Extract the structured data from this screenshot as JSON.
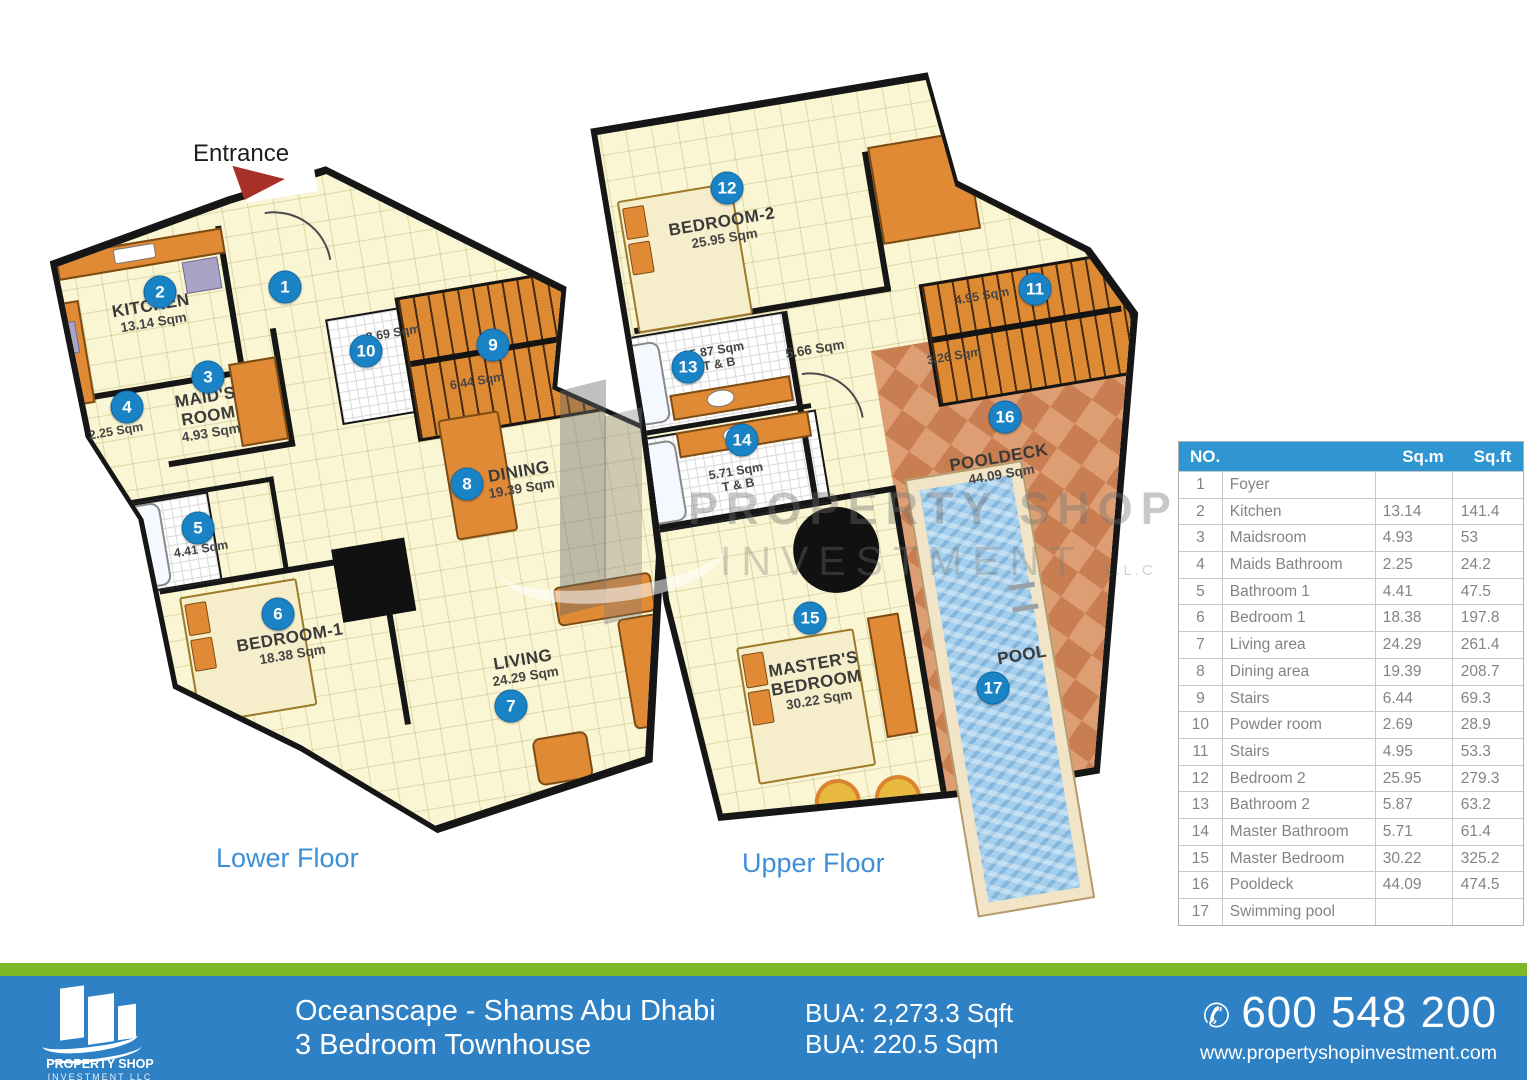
{
  "entrance_label": "Entrance",
  "floor_captions": {
    "lower": "Lower Floor",
    "upper": "Upper Floor"
  },
  "plan": {
    "badges": [
      "1",
      "2",
      "3",
      "4",
      "5",
      "6",
      "7",
      "8",
      "9",
      "10",
      "11",
      "12",
      "13",
      "14",
      "15",
      "16",
      "17"
    ]
  },
  "rooms": {
    "kitchen": {
      "name": "KITCHEN",
      "area": "13.14 Sqm"
    },
    "maids_room": {
      "name": "MAID'S",
      "name2": "ROOM",
      "area": "4.93 Sqm"
    },
    "maids_bathroom": {
      "area": "2.25 Sqm"
    },
    "bathroom1": {
      "area": "4.41 Sqm"
    },
    "bedroom1": {
      "name": "BEDROOM-1",
      "area": "18.38 Sqm"
    },
    "dining": {
      "name": "DINING",
      "area": "19.39 Sqm"
    },
    "living": {
      "name": "LIVING",
      "area": "24.29 Sqm"
    },
    "powder_room": {
      "area": "2.69 Sqm"
    },
    "stairs_lower": {
      "area": "6.44 Sqm"
    },
    "bedroom2": {
      "name": "BEDROOM-2",
      "area": "25.95 Sqm"
    },
    "bathroom2": {
      "area": "5.87 Sqm",
      "sub": "T & B"
    },
    "hallway": {
      "area": "5.66 Sqm"
    },
    "master_bathroom": {
      "area": "5.71 Sqm",
      "sub": "T & B"
    },
    "stairs_upper": {
      "area": "4.95 Sqm"
    },
    "stairs_upper2": {
      "area": "3.26 Sqm"
    },
    "master_bedroom": {
      "name": "MASTER'S",
      "name2": "BEDROOM",
      "area": "30.22 Sqm"
    },
    "pooldeck": {
      "name": "POOLDECK",
      "area": "44.09 Sqm"
    },
    "pool": {
      "name": "POOL"
    }
  },
  "watermark": {
    "line1": "PROPERTY SHOP",
    "line2": "INVESTMENT",
    "line2_suffix": "L.L.C"
  },
  "table": {
    "headers": {
      "no": "NO.",
      "sqm": "Sq.m",
      "sqft": "Sq.ft"
    },
    "rows": [
      {
        "no": "1",
        "name": "Foyer",
        "sqm": "",
        "sqft": ""
      },
      {
        "no": "2",
        "name": "Kitchen",
        "sqm": "13.14",
        "sqft": "141.4"
      },
      {
        "no": "3",
        "name": "Maidsroom",
        "sqm": "4.93",
        "sqft": "53"
      },
      {
        "no": "4",
        "name": "Maids Bathroom",
        "sqm": "2.25",
        "sqft": "24.2"
      },
      {
        "no": "5",
        "name": "Bathroom 1",
        "sqm": "4.41",
        "sqft": "47.5"
      },
      {
        "no": "6",
        "name": "Bedroom 1",
        "sqm": "18.38",
        "sqft": "197.8"
      },
      {
        "no": "7",
        "name": "Living area",
        "sqm": "24.29",
        "sqft": "261.4"
      },
      {
        "no": "8",
        "name": "Dining area",
        "sqm": "19.39",
        "sqft": "208.7"
      },
      {
        "no": "9",
        "name": "Stairs",
        "sqm": "6.44",
        "sqft": "69.3"
      },
      {
        "no": "10",
        "name": "Powder room",
        "sqm": "2.69",
        "sqft": "28.9"
      },
      {
        "no": "11",
        "name": "Stairs",
        "sqm": "4.95",
        "sqft": "53.3"
      },
      {
        "no": "12",
        "name": "Bedroom 2",
        "sqm": "25.95",
        "sqft": "279.3"
      },
      {
        "no": "13",
        "name": "Bathroom 2",
        "sqm": "5.87",
        "sqft": "63.2"
      },
      {
        "no": "14",
        "name": "Master Bathroom",
        "sqm": "5.71",
        "sqft": "61.4"
      },
      {
        "no": "15",
        "name": "Master Bedroom",
        "sqm": "30.22",
        "sqft": "325.2"
      },
      {
        "no": "16",
        "name": "Pooldeck",
        "sqm": "44.09",
        "sqft": "474.5"
      },
      {
        "no": "17",
        "name": "Swimming pool",
        "sqm": "",
        "sqft": ""
      }
    ]
  },
  "footer": {
    "project": "Oceanscape - Shams Abu Dhabi",
    "unit_type": "3 Bedroom Townhouse",
    "bua_sqft": "BUA: 2,273.3 Sqft",
    "bua_sqm": "BUA: 220.5 Sqm",
    "phone_glyph": "✆",
    "phone": "600 548 200",
    "website": "www.propertyshopinvestment.com",
    "logo": {
      "line1": "PROPERTY SHOP",
      "line2": "INVESTMENT LLC"
    }
  },
  "colors": {
    "table_header_blue": "#2f96d2",
    "footer_blue": "#2e81c4",
    "green_bar": "#7db829",
    "badge_blue": "#1a83c6",
    "caption_blue": "#3f8fd8",
    "plan_fill": "#faf5d2",
    "accent_orange": "#e08a36",
    "pool_blue": "#a5cfec",
    "deck_terracotta": "#d6936a",
    "wall_black": "#161616",
    "entrance_arrow_red": "#a93028"
  }
}
